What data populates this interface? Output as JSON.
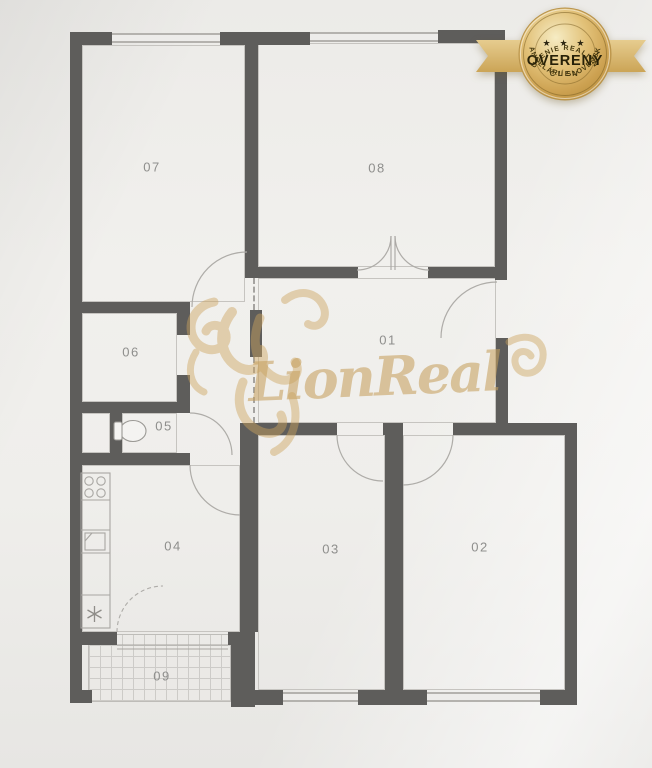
{
  "rooms": {
    "r01": "01",
    "r02": "02",
    "r03": "03",
    "r04": "04",
    "r05": "05",
    "r06": "06",
    "r07": "07",
    "r08": "08",
    "r09": "09"
  },
  "watermark": {
    "brand": "LionReal"
  },
  "badge": {
    "association_top": "ZDRUŽENIE REALITNÝCH",
    "stars": "★ ★ ★",
    "title": "OVERENÝ",
    "member": "ČLEN",
    "association_bottom": "KANCELÁRIÍ SLOVENSKA"
  },
  "colors": {
    "paper": "#efeeeb",
    "wall": "#5e5d5b",
    "thin_line": "#c6c4c0",
    "room_label": "#8e8e8c",
    "watermark_gold": "#cda45e",
    "badge_gold": "#d8b76a",
    "badge_text": "#2a2410"
  }
}
